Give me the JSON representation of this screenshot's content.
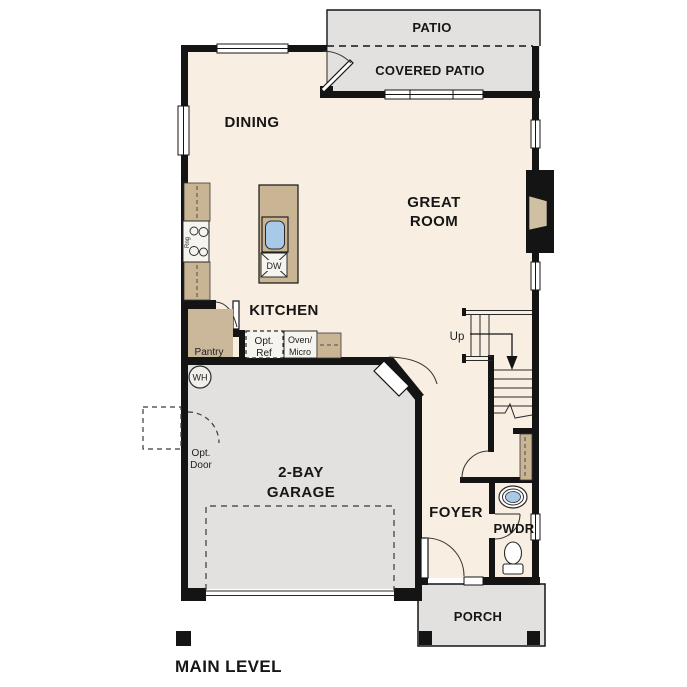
{
  "title": "MAIN LEVEL",
  "rooms": {
    "patio": {
      "label": "PATIO"
    },
    "covered_patio": {
      "label": "COVERED PATIO"
    },
    "dining": {
      "label": "DINING"
    },
    "great_room": {
      "line1": "GREAT",
      "line2": "ROOM"
    },
    "kitchen": {
      "label": "KITCHEN"
    },
    "garage": {
      "line1": "2-BAY",
      "line2": "GARAGE"
    },
    "foyer": {
      "label": "FOYER"
    },
    "powder": {
      "label": "PWDR"
    },
    "porch": {
      "label": "PORCH"
    }
  },
  "fixtures": {
    "pantry": {
      "label": "Pantry"
    },
    "opt_ref": {
      "line1": "Opt.",
      "line2": "Ref"
    },
    "oven_micro": {
      "line1": "Oven/",
      "line2": "Micro"
    },
    "dishwasher": {
      "label": "DW"
    },
    "range": {
      "label": "Rng"
    },
    "water_heater": {
      "label": "WH"
    },
    "opt_door": {
      "line1": "Opt.",
      "line2": "Door"
    },
    "stairs": {
      "label": "Up"
    }
  },
  "colors": {
    "floor": "#f8efe2",
    "hard_surface": "#e2e1df",
    "casework_tan": "#c9b594",
    "wall": "#141414",
    "sink_blue": "#a9c9e9"
  }
}
